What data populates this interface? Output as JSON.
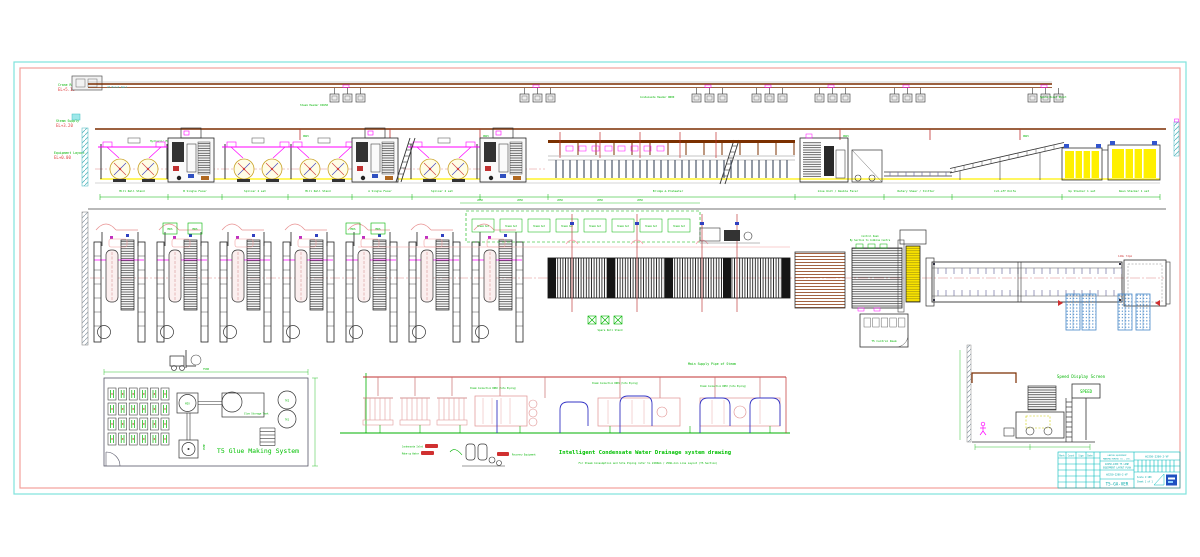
{
  "drawing": {
    "elevation_labels": [
      {
        "label": "Crane Rail",
        "code": "EL+5.15"
      },
      {
        "label": "Steam Supply",
        "code": "EL+3.20"
      },
      {
        "label": "Equipment Layout",
        "code": "EL+0.00"
      }
    ],
    "top_band": {
      "notes": [
        "2T Hoist Rail",
        "Hydraulic Mill Roll Stand",
        "Steam Header DN150",
        "Condensate Header DN80",
        "Spare Hoist Point"
      ],
      "drop_label": "DN25",
      "station_labels": [
        "Mill Roll Stand",
        "B Single Facer",
        "Splicer 2 set",
        "Mill Roll Stand",
        "A Single Facer",
        "Splicer 2 set",
        "Bridge & Preheater",
        "Glue Unit / Double Facer",
        "Rotary Shear / Slitter",
        "Cut-off Knife",
        "Up Stacker 1 set",
        "Down Stacker 1 set"
      ]
    },
    "mid_band": {
      "roll_box_label": "MRS",
      "dashed_box_label": "Steam Set",
      "buffer_label": "Spare Roll Stand",
      "control_desk_line1": "Control Desk",
      "control_desk_line2": "By Section to Combine Centre",
      "control_room": "T5 Control Room",
      "conveyor_note": "14WL 72pm",
      "dim_label": "2050"
    },
    "glue_room": {
      "title": "T5 Glue Making System",
      "mixer": "MIX",
      "tank_top": "TK2",
      "tank_bottom": "TK1",
      "storage": "Glue Storage Tank",
      "pump": "PUMP",
      "dim_top": "7500"
    },
    "schematic": {
      "steam_main_label": "Main Supply Pipe of Steam",
      "pipe_labels": [
        "Steam Connection DN80 (Site Piping)",
        "Steam Connection DN65 (Site Piping)",
        "Steam Connection DN50 (Site Piping)"
      ],
      "recovery_labels": [
        "Condensate Inlet",
        "Make-up Water",
        "Recovery Equipment"
      ],
      "title": "Intelligent Condensate Water Drainage system drawing",
      "note": "For Steam Consumption and Site Piping refer to 2200mm / 250m-min Line Layout (T5 Section)"
    },
    "speed_area": {
      "label": "Speed Display Screen",
      "screen": "SPEED"
    },
    "title_block": {
      "company_line1": "CARTON EQUIPMENT",
      "company_line2": "MANUFACTURING CO., LTD.",
      "project_line1": "WJ250-2200 T5 LINE",
      "project_line2": "EQUIPMENT LAYOUT PLAN",
      "drawing_no": "WJ250-2200-2-VF",
      "code": "T5-GA-VER",
      "rev_headers": [
        "Mark",
        "Count",
        "Sign",
        "Date"
      ],
      "scale": "Scale 1:100",
      "sheet": "Sheet 1 of 1"
    },
    "colors": {
      "frame_outer": "#7FE3DC",
      "frame_inner": "#F2A09B",
      "rail": "#7B2D00",
      "green": "#00B400",
      "magenta": "#FF00FF",
      "yellow": "#FFF000",
      "red": "#D03030",
      "blue": "#3040C0",
      "cyan": "#00BCBC",
      "pallet_blue": "#4788C8"
    }
  }
}
